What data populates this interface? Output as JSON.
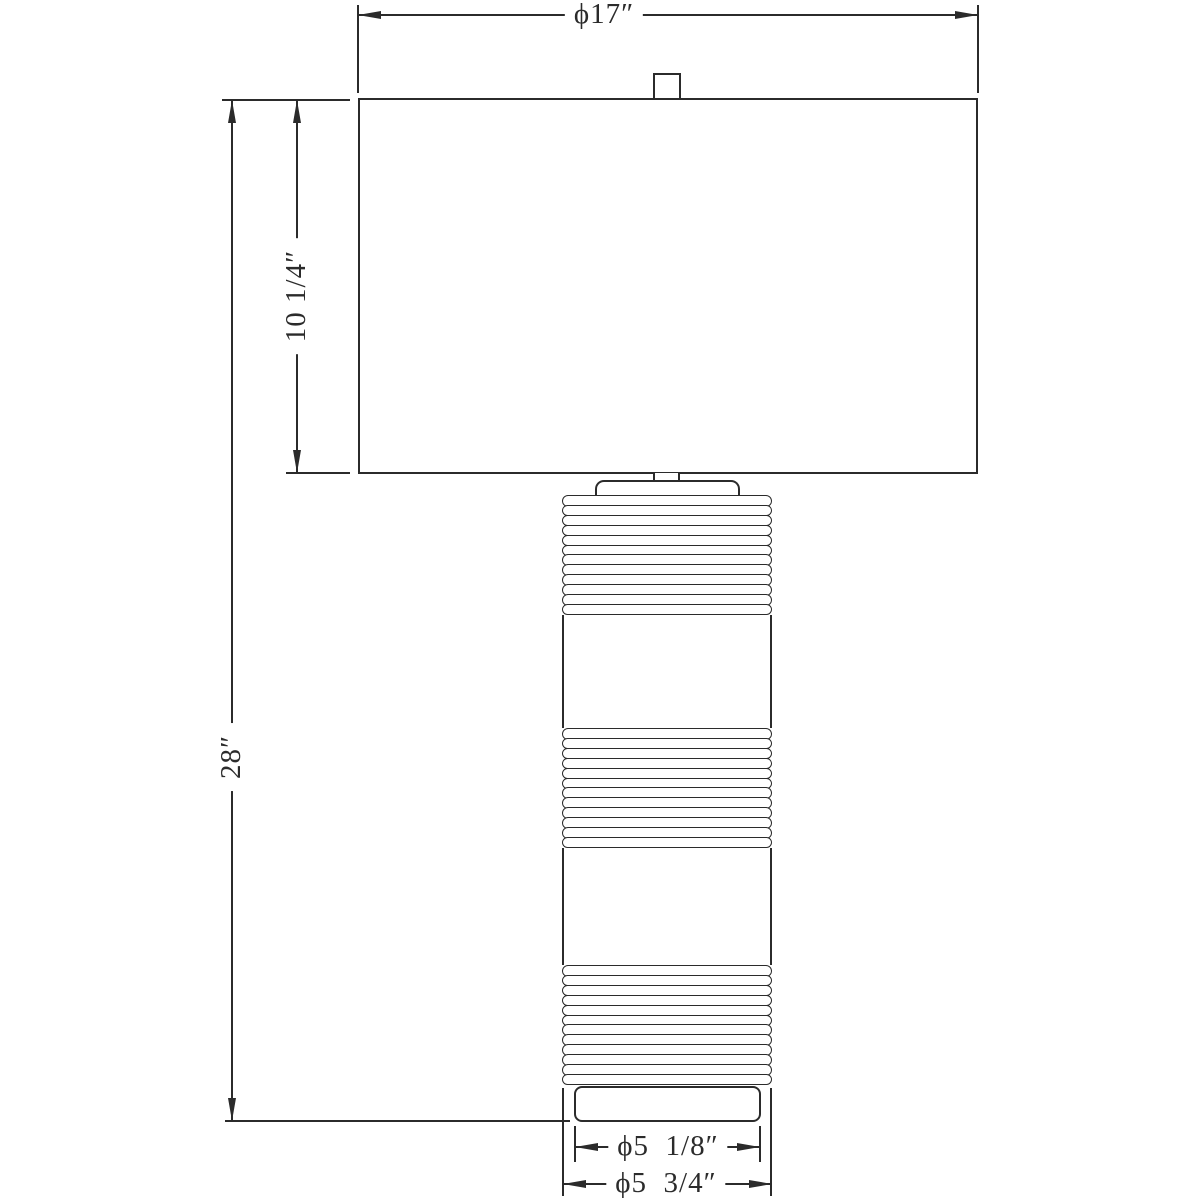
{
  "drawing": {
    "dimensions": {
      "shade_diameter": "ϕ17″",
      "shade_height": "10 1/4″",
      "overall_height": "28″",
      "base_diameter": "ϕ5  1/8″",
      "body_diameter": "ϕ5  3/4″"
    },
    "lamp": {
      "rib_sections": [
        12,
        12,
        12
      ]
    },
    "colors": {
      "line": "#2b2b2b",
      "background": "#ffffff"
    }
  }
}
